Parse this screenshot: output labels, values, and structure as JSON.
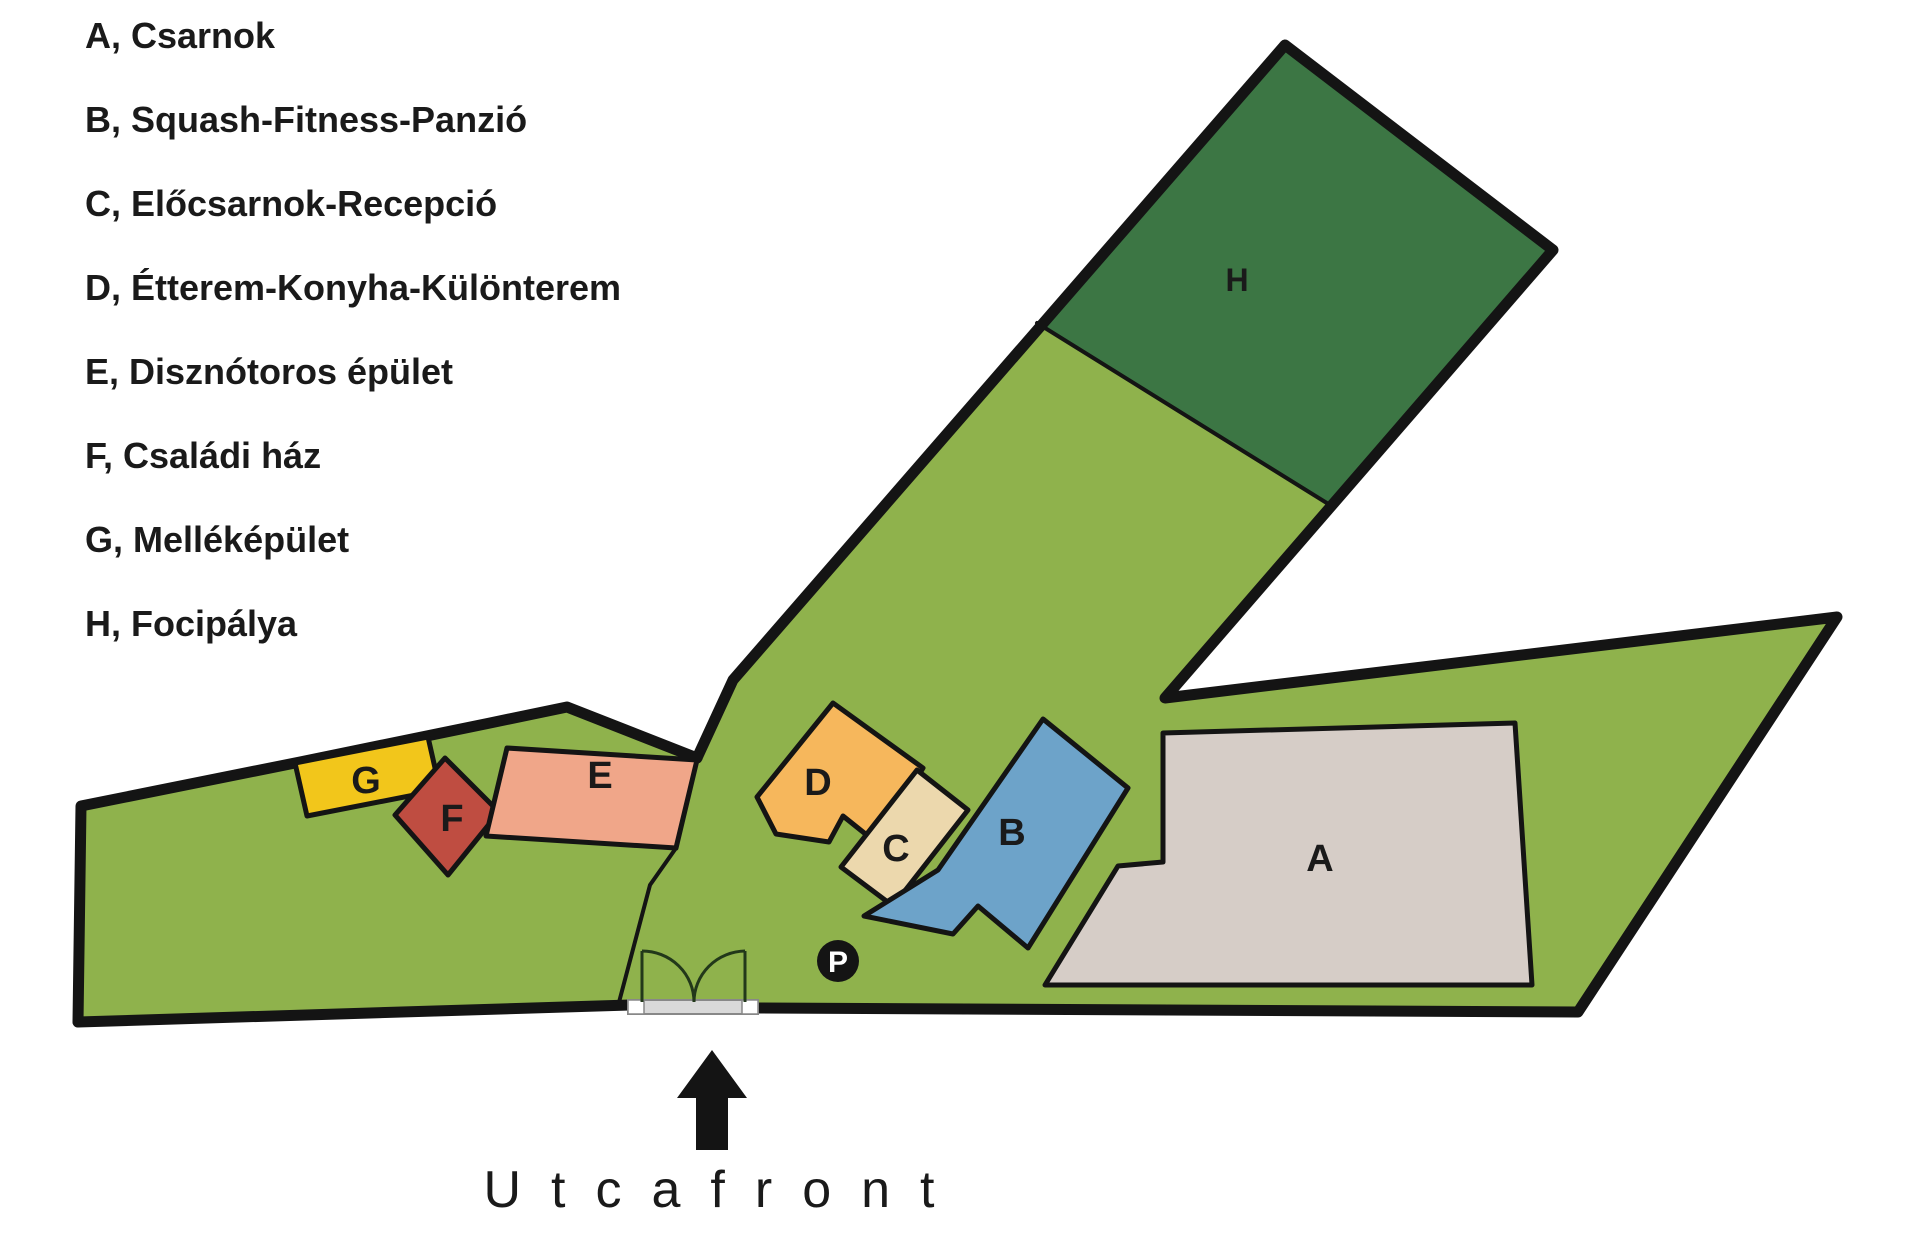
{
  "legend": {
    "items": [
      {
        "key": "A",
        "label": "A, Csarnok"
      },
      {
        "key": "B",
        "label": "B, Squash-Fitness-Panzió"
      },
      {
        "key": "C",
        "label": "C, Előcsarnok-Recepció"
      },
      {
        "key": "D",
        "label": "D, Étterem-Konyha-Különterem"
      },
      {
        "key": "E",
        "label": "E, Disznótoros épület"
      },
      {
        "key": "F",
        "label": "F, Családi ház"
      },
      {
        "key": "G",
        "label": "G, Melléképület"
      },
      {
        "key": "H",
        "label": "H, Focipálya"
      }
    ]
  },
  "street": {
    "label": "Utcafront"
  },
  "map": {
    "width": 1920,
    "height": 1242,
    "colors": {
      "site_green": "#8fb24c",
      "field_green": "#3c7644",
      "outline": "#141414",
      "background": "#ffffff"
    },
    "parcels": [
      {
        "name": "parcel-left",
        "points": "78,1022 81,806 300,762 490,723 567,707 697,758 676,848 650,885 618,1006"
      },
      {
        "name": "parcel-main",
        "points": "1285,45 1553,250 1165,698 1837,617 1578,1012 637,1006 618,1006 650,885 676,848 697,758 733,680"
      }
    ],
    "field": {
      "name": "football-field",
      "key": "H",
      "fill_key": "field_green",
      "points": "1285,45 1553,250 1330,505 1037,323",
      "label_x": 1237,
      "label_y": 291,
      "label_size": 32
    },
    "thin_lines": [
      {
        "name": "field-divider",
        "d": "M1037,323 L1330,505",
        "width": 4
      },
      {
        "name": "parcel-divider",
        "d": "M688,795 L676,848 L650,885 L618,1006",
        "width": 4
      }
    ],
    "thick_lines": [
      {
        "name": "boundary-left-parcel",
        "d": "M78,1022 L81,806 L300,762 L490,723 L567,707 L697,758",
        "width": 11
      },
      {
        "name": "boundary-main-parcel",
        "d": "M697,758 L733,680 L1285,45 L1553,250 L1165,698 L1837,617 L1578,1012 L756,1008",
        "width": 11
      },
      {
        "name": "boundary-bottom-left",
        "d": "M630,1005 L78,1022",
        "width": 11
      }
    ],
    "buildings": [
      {
        "key": "G",
        "fill": "#f2c61b",
        "points": "295,763 428,737 440,790 307,816",
        "label_x": 366,
        "label_y": 793
      },
      {
        "key": "F",
        "fill": "#bf4d41",
        "points": "445,758 499,812 448,875 395,815",
        "label_x": 452,
        "label_y": 831
      },
      {
        "key": "E",
        "fill": "#f0a689",
        "points": "507,748 697,760 676,848 486,836",
        "label_x": 600,
        "label_y": 788
      },
      {
        "key": "D",
        "fill": "#f6b75c",
        "points": "833,703 923,768 878,844 843,816 829,842 776,834 757,797",
        "label_x": 818,
        "label_y": 795
      },
      {
        "key": "C",
        "fill": "#ecd8ad",
        "points": "917,770 968,810 893,906 841,867",
        "label_x": 896,
        "label_y": 861
      },
      {
        "key": "B",
        "fill": "#6da3c9",
        "points": "1043,719 1128,788 1028,948 978,906 953,934 864,916 938,870",
        "label_x": 1012,
        "label_y": 845
      },
      {
        "key": "A",
        "fill": "#d6cdc7",
        "points": "1163,733 1515,723 1532,985 1045,985 1118,866 1163,862",
        "label_x": 1320,
        "label_y": 871
      }
    ],
    "parking": {
      "label": "P",
      "x": 838,
      "y": 961,
      "r": 21,
      "fill": "#141414",
      "text_color": "#ffffff"
    },
    "gate": {
      "line_color": "#22381a",
      "left_post": "M642,951 L642,1002",
      "right_post": "M745,951 L745,1002",
      "left_arc": "M642,951 A52,51 0 0 1 694,1002",
      "right_arc": "M745,951 A52,51 0 0 0 694,1002",
      "threshold": {
        "x": 628,
        "y": 1000,
        "w": 130,
        "h": 14,
        "end_w": 16,
        "fill": "#d9d9d9",
        "end_fill": "#ffffff",
        "stroke": "#888888"
      }
    },
    "arrow": {
      "name": "street-entrance-arrow",
      "points": "712,1050 747,1098 728,1098 728,1150 696,1150 696,1098 677,1098"
    }
  }
}
